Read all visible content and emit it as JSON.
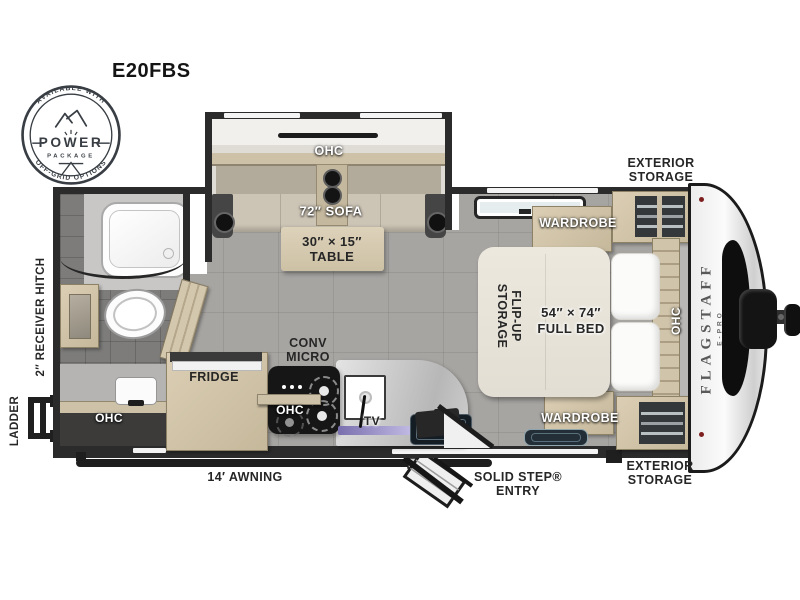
{
  "title": "E20FBS",
  "badge": {
    "top_arc": "AVAILABLE WITH",
    "name": "POWER",
    "subname": "PACKAGE",
    "bottom_arc": "OFF-GRID OPTIONS"
  },
  "brand": {
    "name": "FLAGSTAFF",
    "series": "E-PRO"
  },
  "labels": {
    "ohc_slide": "OHC",
    "sofa": "72″ SOFA",
    "table_l1": "30″ × 15″",
    "table_l2": "TABLE",
    "ext_storage_l1": "EXTERIOR",
    "ext_storage_l2": "STORAGE",
    "wardrobe_top": "WARDROBE",
    "wardrobe_bottom": "WARDROBE",
    "flip_up_l1": "FLIP-UP",
    "flip_up_l2": "STORAGE",
    "bed_l1": "54″ × 74″",
    "bed_l2": "FULL BED",
    "ohc_bed": "OHC",
    "receiver_hitch": "2″ RECEIVER HITCH",
    "ladder": "LADDER",
    "ohc_bath": "OHC",
    "fridge": "FRIDGE",
    "conv_l1": "CONV",
    "conv_l2": "MICRO",
    "ohc_kitchen": "OHC",
    "tv": "TV",
    "awning": "14′ AWNING",
    "step_l1": "SOLID STEP®",
    "step_l2": "ENTRY"
  },
  "colors": {
    "wall": "#2b2b2b",
    "wood": "#d0c4ab",
    "floor": "#a7a5a2",
    "bath_floor": "#7d7c7a",
    "bed": "#eae6dc",
    "appliance_black": "#161616",
    "counter_silver": "#c9c9c9",
    "underglow_purple": "#8d82c4"
  }
}
